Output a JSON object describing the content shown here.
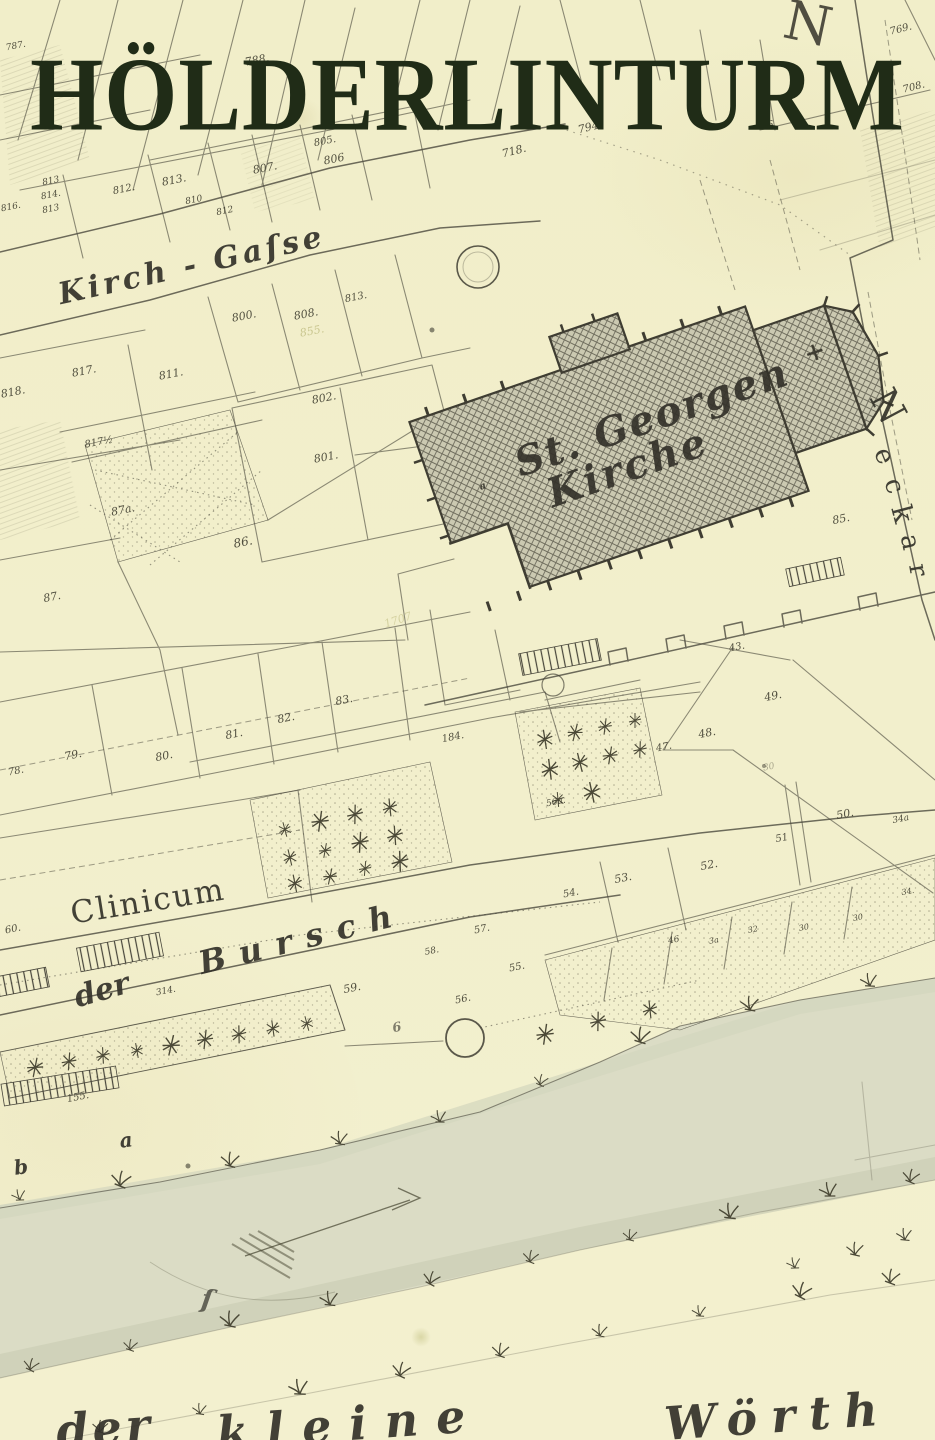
{
  "title": {
    "text": "HÖLDERLINTURM"
  },
  "colors": {
    "paper": "#f2efcc",
    "ink": "#47453a",
    "title_ink": "#202c17",
    "church_hatch_base": "#cbc9b1",
    "river_wash": "#dbdcc5"
  },
  "map": {
    "major_labels": [
      {
        "t": "Kirch - Gaſse",
        "x": 192,
        "y": 266,
        "s": 30,
        "r": -12.5,
        "ls": 4,
        "c": "script",
        "n": "street-label-kirch-gasse"
      },
      {
        "t": "St. Georgen",
        "x": 652,
        "y": 418,
        "s": 40,
        "r": -19,
        "ls": 2,
        "c": "script",
        "n": "church-label-line-1"
      },
      {
        "t": "Kirche",
        "x": 628,
        "y": 468,
        "s": 40,
        "r": -19,
        "ls": 3,
        "c": "script",
        "n": "church-label-line-2"
      },
      {
        "t": "Clinicum",
        "x": 148,
        "y": 902,
        "s": 31,
        "r": -9,
        "ls": 2,
        "c": "roman",
        "n": "building-label-clinicum"
      },
      {
        "t": "der",
        "x": 102,
        "y": 991,
        "s": 30,
        "r": -16,
        "c": "script",
        "n": "street-label-der"
      },
      {
        "t": "Bursch",
        "x": 302,
        "y": 938,
        "s": 32,
        "r": -14,
        "ls": 14,
        "c": "script",
        "n": "street-label-bursch"
      },
      {
        "t": "N",
        "x": 888,
        "y": 406,
        "s": 38,
        "r": 62,
        "c": "roman",
        "n": "river-label-neckar-n"
      },
      {
        "t": "e",
        "x": 884,
        "y": 456,
        "s": 26,
        "r": 68,
        "c": "roman",
        "n": "river-label-neckar-e"
      },
      {
        "t": "c",
        "x": 894,
        "y": 486,
        "s": 26,
        "r": 72,
        "c": "roman",
        "n": "river-label-neckar-c"
      },
      {
        "t": "k",
        "x": 902,
        "y": 514,
        "s": 28,
        "r": 75,
        "c": "roman",
        "n": "river-label-neckar-k"
      },
      {
        "t": "a",
        "x": 910,
        "y": 542,
        "s": 26,
        "r": 78,
        "c": "roman",
        "n": "river-label-neckar-a"
      },
      {
        "t": "r",
        "x": 918,
        "y": 570,
        "s": 26,
        "r": 80,
        "c": "roman",
        "n": "river-label-neckar-r"
      },
      {
        "t": "N",
        "x": 808,
        "y": 24,
        "s": 54,
        "r": 12,
        "o": 0.85,
        "c": "roman",
        "n": "map-letter-n"
      },
      {
        "t": "der",
        "x": 105,
        "y": 1428,
        "s": 46,
        "r": -4,
        "ls": 4,
        "c": "script",
        "n": "island-label-der"
      },
      {
        "t": "kleine",
        "x": 350,
        "y": 1424,
        "s": 46,
        "r": -4,
        "ls": 18,
        "c": "script",
        "n": "island-label-kleine"
      },
      {
        "t": "Wörth",
        "x": 778,
        "y": 1416,
        "s": 46,
        "r": -4,
        "ls": 14,
        "c": "script",
        "n": "island-label-woerth"
      },
      {
        "t": "a",
        "x": 126,
        "y": 1140,
        "s": 20,
        "r": -8,
        "c": "script",
        "n": "bank-label-a"
      },
      {
        "t": "b",
        "x": 21,
        "y": 1167,
        "s": 20,
        "r": -8,
        "c": "script",
        "n": "bank-label-b"
      },
      {
        "t": "a",
        "x": 483,
        "y": 487,
        "s": 10,
        "r": -19,
        "c": "script",
        "n": "church-court-label-a"
      },
      {
        "t": "ſ",
        "x": 207,
        "y": 1300,
        "s": 26,
        "r": 8,
        "o": 0.7,
        "c": "script",
        "n": "river-flourish"
      },
      {
        "t": "6",
        "x": 397,
        "y": 1028,
        "s": 13,
        "o": 0.6,
        "c": "script",
        "n": "small-label-6"
      }
    ],
    "parcel_numbers": [
      {
        "t": "787.",
        "x": 16,
        "y": 47,
        "s": 9
      },
      {
        "t": "788.",
        "x": 257,
        "y": 60,
        "s": 11
      },
      {
        "t": "769.",
        "x": 901,
        "y": 30,
        "s": 10,
        "r": -14
      },
      {
        "t": "708.",
        "x": 914,
        "y": 88,
        "s": 10,
        "r": -14
      },
      {
        "t": "66.",
        "x": 769,
        "y": 126,
        "s": 10
      },
      {
        "t": "794.",
        "x": 590,
        "y": 127,
        "s": 11,
        "r": -14
      },
      {
        "t": "718.",
        "x": 514,
        "y": 151,
        "s": 11,
        "r": -14
      },
      {
        "t": "805.",
        "x": 325,
        "y": 142,
        "s": 10
      },
      {
        "t": "806",
        "x": 334,
        "y": 159,
        "s": 11
      },
      {
        "t": "807.",
        "x": 265,
        "y": 168,
        "s": 11
      },
      {
        "t": "813.",
        "x": 174,
        "y": 180,
        "s": 11
      },
      {
        "t": "812.",
        "x": 124,
        "y": 190,
        "s": 10
      },
      {
        "t": "810",
        "x": 194,
        "y": 201,
        "s": 9
      },
      {
        "t": "812",
        "x": 225,
        "y": 212,
        "s": 9
      },
      {
        "t": "813",
        "x": 51,
        "y": 182,
        "s": 9
      },
      {
        "t": "814.",
        "x": 51,
        "y": 196,
        "s": 9
      },
      {
        "t": "813",
        "x": 51,
        "y": 210,
        "s": 9
      },
      {
        "t": "816.",
        "x": 11,
        "y": 208,
        "s": 9
      },
      {
        "t": "800.",
        "x": 244,
        "y": 316,
        "s": 11
      },
      {
        "t": "808.",
        "x": 306,
        "y": 314,
        "s": 11
      },
      {
        "t": "813.",
        "x": 356,
        "y": 298,
        "s": 10
      },
      {
        "t": "855.",
        "x": 312,
        "y": 331,
        "s": 11,
        "o": 0.55,
        "c": "faint-olive"
      },
      {
        "t": "817.",
        "x": 84,
        "y": 371,
        "s": 11
      },
      {
        "t": "811.",
        "x": 171,
        "y": 374,
        "s": 11
      },
      {
        "t": "802.",
        "x": 324,
        "y": 398,
        "s": 11
      },
      {
        "t": "801.",
        "x": 326,
        "y": 457,
        "s": 11
      },
      {
        "t": "817½",
        "x": 99,
        "y": 443,
        "s": 10
      },
      {
        "t": "818.",
        "x": 13,
        "y": 392,
        "s": 11
      },
      {
        "t": "87a.",
        "x": 123,
        "y": 510,
        "s": 11
      },
      {
        "t": "86.",
        "x": 243,
        "y": 542,
        "s": 12
      },
      {
        "t": "87.",
        "x": 52,
        "y": 597,
        "s": 11
      },
      {
        "t": "85.",
        "x": 841,
        "y": 519,
        "s": 11
      },
      {
        "t": "1707",
        "x": 398,
        "y": 620,
        "s": 11,
        "r": -18,
        "o": 0.4,
        "c": "faint-olive"
      },
      {
        "t": "78.",
        "x": 16,
        "y": 772,
        "s": 10
      },
      {
        "t": "79.",
        "x": 73,
        "y": 755,
        "s": 11
      },
      {
        "t": "80.",
        "x": 164,
        "y": 756,
        "s": 11
      },
      {
        "t": "81.",
        "x": 234,
        "y": 734,
        "s": 11
      },
      {
        "t": "82.",
        "x": 286,
        "y": 718,
        "s": 11
      },
      {
        "t": "83.",
        "x": 344,
        "y": 700,
        "s": 11
      },
      {
        "t": "184.",
        "x": 453,
        "y": 738,
        "s": 10
      },
      {
        "t": "43.",
        "x": 737,
        "y": 648,
        "s": 10
      },
      {
        "t": "49.",
        "x": 773,
        "y": 696,
        "s": 11
      },
      {
        "t": "48.",
        "x": 707,
        "y": 733,
        "s": 11
      },
      {
        "t": "47.",
        "x": 664,
        "y": 748,
        "s": 10
      },
      {
        "t": "30",
        "x": 769,
        "y": 768,
        "s": 9,
        "o": 0.4
      },
      {
        "t": "50.",
        "x": 845,
        "y": 814,
        "s": 11
      },
      {
        "t": "51",
        "x": 782,
        "y": 839,
        "s": 10
      },
      {
        "t": "52.",
        "x": 709,
        "y": 865,
        "s": 11
      },
      {
        "t": "53.",
        "x": 623,
        "y": 878,
        "s": 11
      },
      {
        "t": "54.",
        "x": 571,
        "y": 894,
        "s": 10
      },
      {
        "t": "56a.",
        "x": 556,
        "y": 803,
        "s": 9
      },
      {
        "t": "34a",
        "x": 901,
        "y": 820,
        "s": 9
      },
      {
        "t": "57.",
        "x": 482,
        "y": 930,
        "s": 10
      },
      {
        "t": "58.",
        "x": 432,
        "y": 952,
        "s": 9
      },
      {
        "t": "55.",
        "x": 517,
        "y": 968,
        "s": 10
      },
      {
        "t": "56.",
        "x": 463,
        "y": 1000,
        "s": 10
      },
      {
        "t": "59.",
        "x": 352,
        "y": 988,
        "s": 11
      },
      {
        "t": "60.",
        "x": 13,
        "y": 930,
        "s": 10
      },
      {
        "t": "314.",
        "x": 166,
        "y": 992,
        "s": 9
      },
      {
        "t": "46",
        "x": 674,
        "y": 941,
        "s": 9
      },
      {
        "t": "3a",
        "x": 714,
        "y": 941,
        "s": 8
      },
      {
        "t": "32",
        "x": 753,
        "y": 930,
        "s": 8
      },
      {
        "t": "30",
        "x": 804,
        "y": 928,
        "s": 8
      },
      {
        "t": "30",
        "x": 858,
        "y": 918,
        "s": 8
      },
      {
        "t": "34.",
        "x": 908,
        "y": 892,
        "s": 8
      },
      {
        "t": "155.",
        "x": 78,
        "y": 1098,
        "s": 10
      }
    ]
  }
}
